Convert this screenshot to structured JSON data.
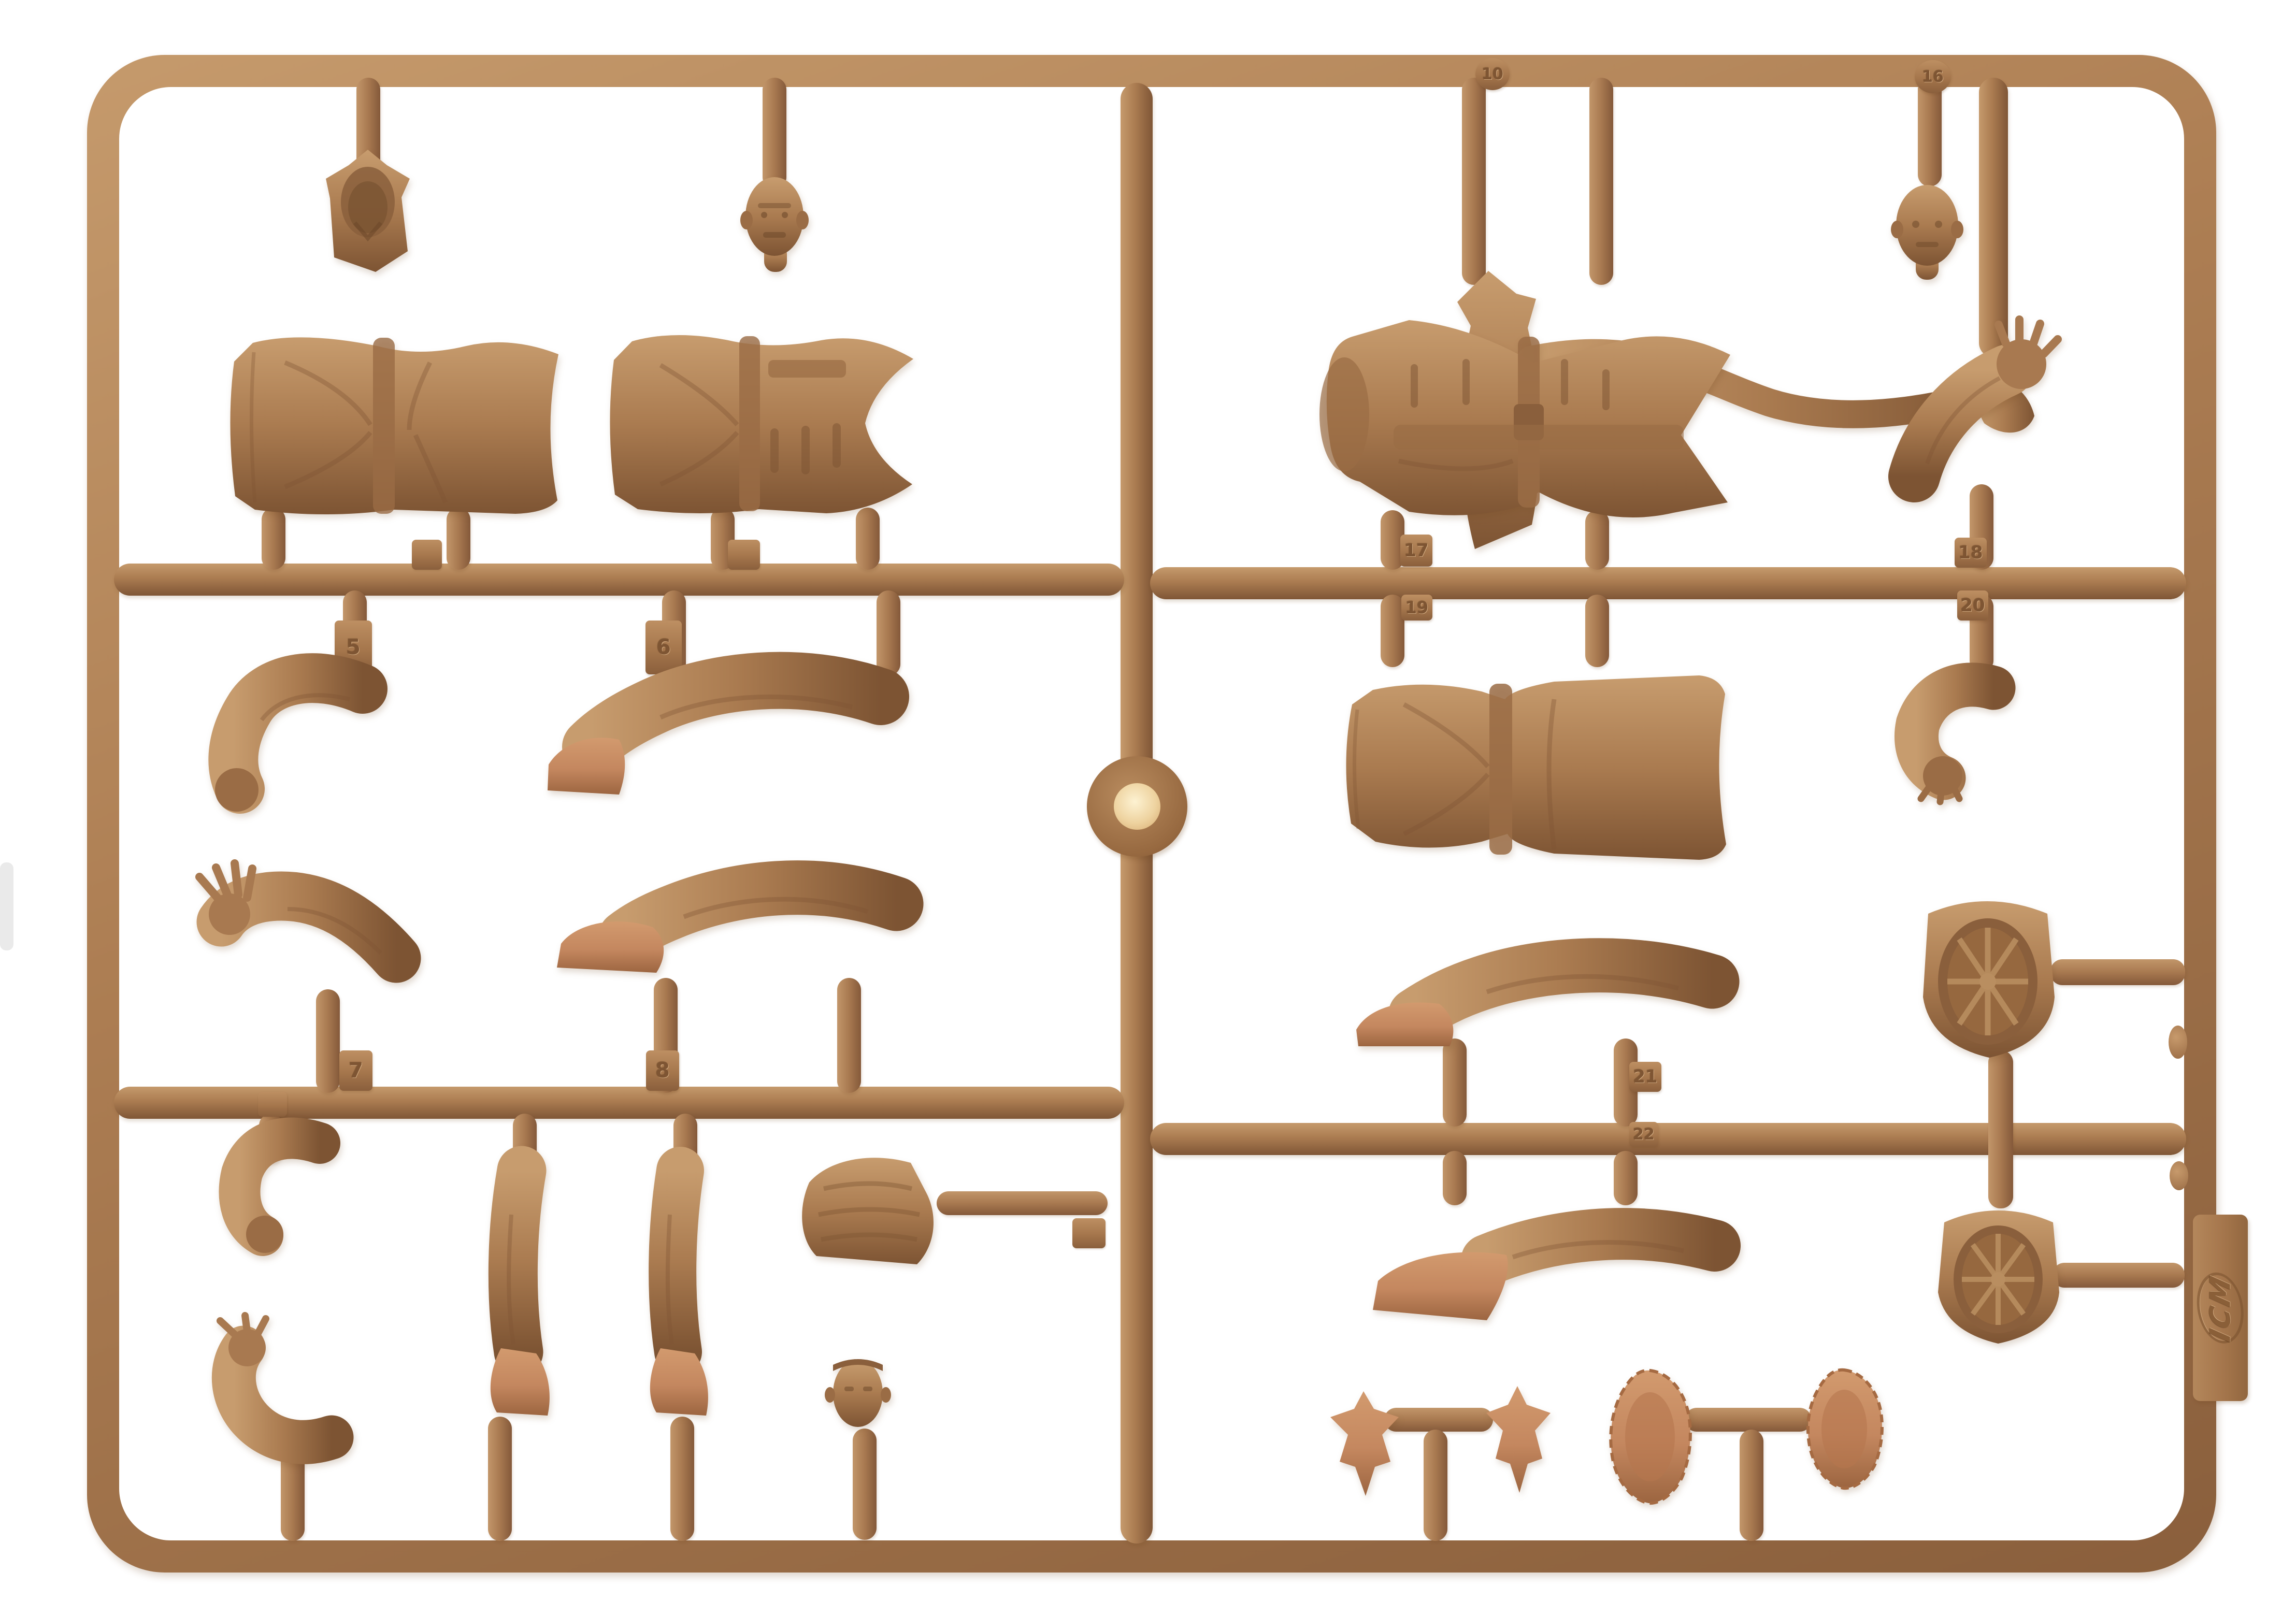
{
  "brand": {
    "logo_text": "ICM"
  },
  "colors": {
    "background": "#ffffff",
    "plastic_base": "#ab7c51",
    "plastic_highlight": "#c59a6c",
    "plastic_shadow": "#7f5636",
    "accent_small_parts": "#c4875f",
    "injection_gate_center": "#eed3a0"
  },
  "mold": {
    "number_tabs": {
      "n5": "5",
      "n6": "6",
      "n7": "7",
      "n8": "8",
      "n17": "17",
      "n18": "18",
      "n19": "19",
      "n20": "20",
      "n21": "21",
      "n22": "22"
    },
    "rail_marks": {
      "m10": "10",
      "m16": "16"
    },
    "parts": [
      "head-with-collar",
      "head-bare",
      "tunic-back",
      "tunic-front",
      "bent-arm-sleeve",
      "leg-with-boot-bent",
      "arm-open-hand",
      "leg-straight-boot",
      "small-bent-arm",
      "leg-boot-front-left",
      "leg-boot-front-right",
      "folded-coat",
      "arm-reaching",
      "small-head",
      "fire-axe",
      "head-bare-2",
      "greatcoat-back",
      "arm-raised-palm",
      "greatcoat-front",
      "forearm-glove",
      "leg-horizontal",
      "boot-leg-horizontal",
      "peaked-cap-1",
      "peaked-cap-2",
      "eagle-insignia-1",
      "eagle-insignia-2",
      "oval-plate-1",
      "oval-plate-2"
    ]
  }
}
